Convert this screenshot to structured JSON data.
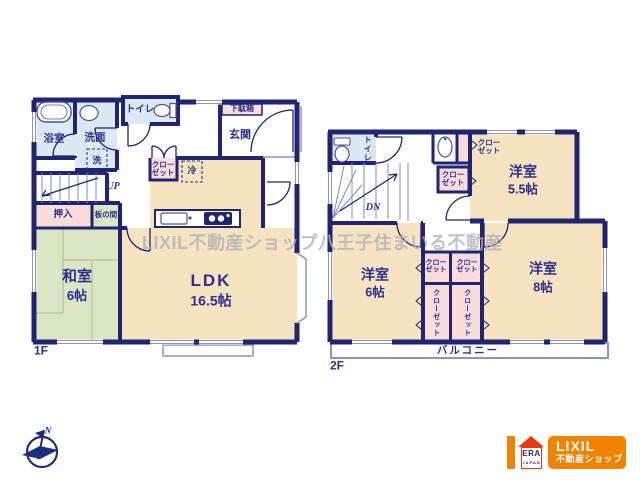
{
  "plan_1f": {
    "floor_label": "1F",
    "bath": "浴室",
    "washroom": "洗面",
    "laundry": "洗",
    "toilet": "トイレ",
    "shoe_cabinet": "下駄箱",
    "entrance": "玄関",
    "closet_line1": "クロー",
    "closet_line2": "ゼット",
    "fridge": "冷",
    "stairs": "UP",
    "oshiire": "押入",
    "itanoma": "板の間",
    "tatami_room": "和室",
    "tatami_size": "6帖",
    "ldk": "LDK",
    "ldk_size": "16.5帖"
  },
  "plan_2f": {
    "floor_label": "2F",
    "toilet": "トイレ",
    "stairs": "DN",
    "closet_line1": "クロー",
    "closet_line2": "ゼット",
    "closet_vertical": "クローゼット",
    "room_a": "洋室",
    "room_a_size": "5.5帖",
    "room_b": "洋室",
    "room_b_size": "6帖",
    "room_c": "洋室",
    "room_c_size": "8帖",
    "balcony": "バルコニー"
  },
  "watermark": "LIXIL不動産ショップ八王子住まいる不動産",
  "compass_north": "N",
  "logo": {
    "era": "ERA",
    "era_country": "JAPAN",
    "brand": "LIXIL",
    "brand_sub": "不動産ショップ"
  },
  "colors": {
    "wall_navy": "#1f2570",
    "room_beige": "#f6e3c0",
    "tatami_green": "#dbe7c4",
    "water_blue": "#dbe9f4",
    "closet_pink": "#fbdcdc",
    "brand_orange": "#f08300",
    "era_red": "#e8380d"
  }
}
